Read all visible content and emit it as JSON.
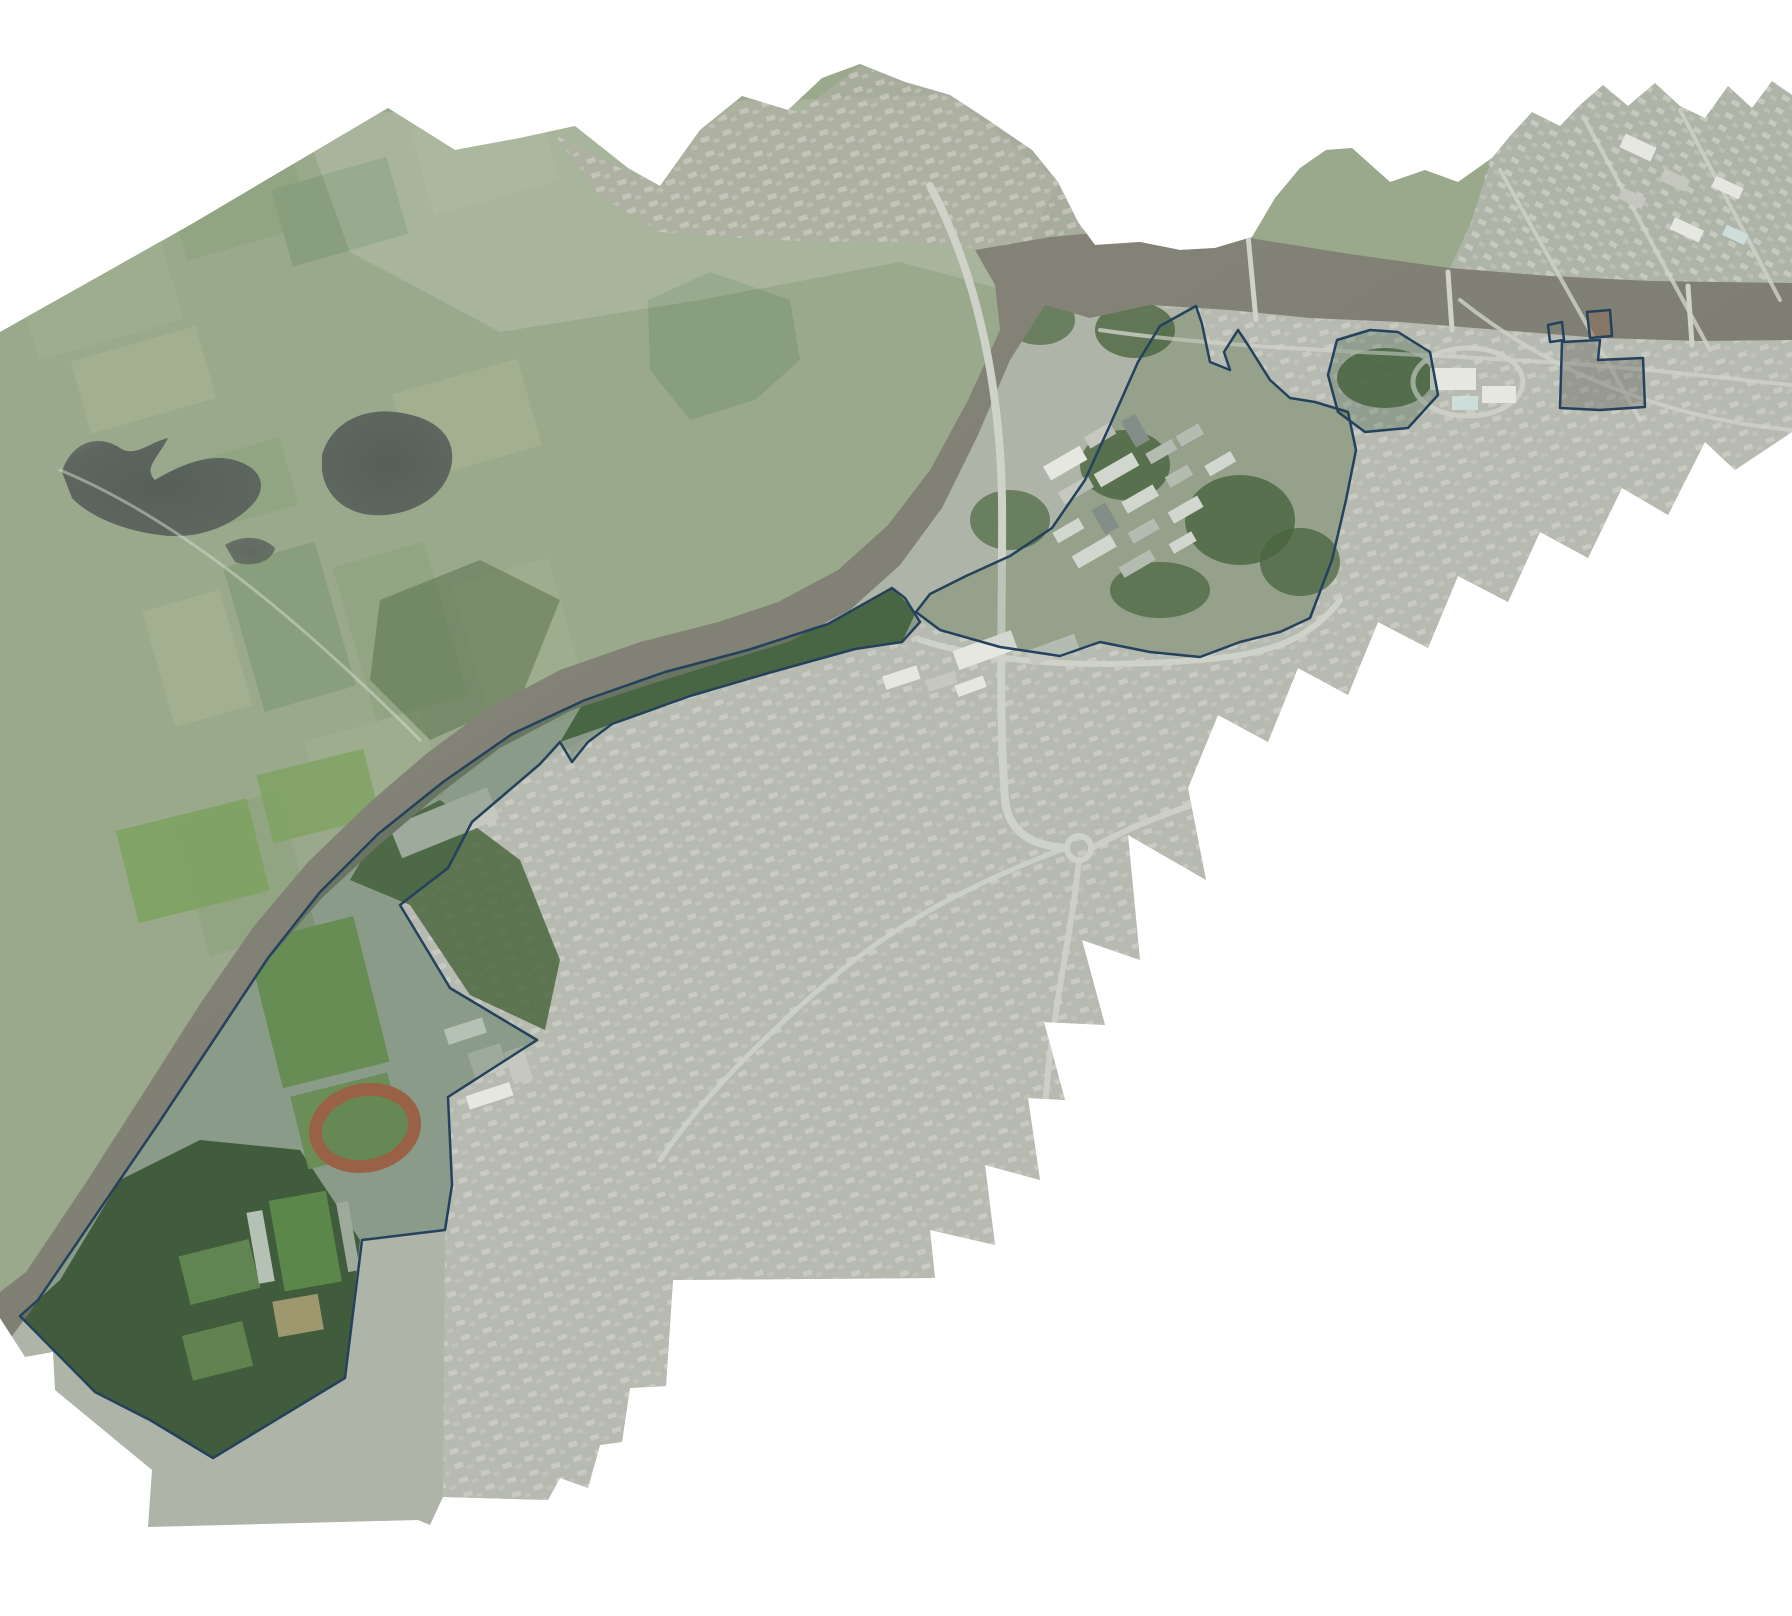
{
  "figure": {
    "kind": "aerial-photomosaic",
    "background": "#ffffff",
    "lake_count": 2,
    "outlined_parcel_count": 7
  },
  "palette": {
    "background": "#ffffff",
    "base_land": "#aeb4a7",
    "rural": "#9aa98c",
    "rural_wash": "#ffffff",
    "field_a": "#8da37c",
    "field_b": "#a2b18f",
    "field_c": "#7c9670",
    "field_d": "#aab693",
    "woodland": "#4d6741",
    "woodland_dark": "#41593a",
    "lake": "#59625c",
    "river": "#7f7e73",
    "urban": "#b7bab1",
    "urban_block": "#d7d8d1",
    "urban_block_2": "#c9cbc3",
    "strip_residential": "#b2afa6",
    "road": "#cfd2c9",
    "navy": "#24425d",
    "track_ring": "#c06a50",
    "track_infield": "#7e9b62",
    "pitch": "#6f9b55",
    "sports_field": "#7fa263",
    "sand": "#c8b184",
    "building_light": "#e6e7e1",
    "building_mid": "#c6c8c0",
    "building_dark": "#8f9695",
    "building_teal": "#cdddd9",
    "building_brown": "#8a6f5b",
    "campus_land": "#a3ab97",
    "parcel_tint": "rgba(30,75,42,0.24)",
    "campus_tint": "rgba(30,75,42,0.10)"
  },
  "features": {
    "river_label": "river",
    "lakes_label": "lakes",
    "rural_label": "rural-farmland",
    "urban_label": "urban-area",
    "campus_label": "outlined-campus-lands",
    "sports_label": "sports-grounds",
    "track_label": "athletics-track",
    "stadium_label": "stadium"
  }
}
